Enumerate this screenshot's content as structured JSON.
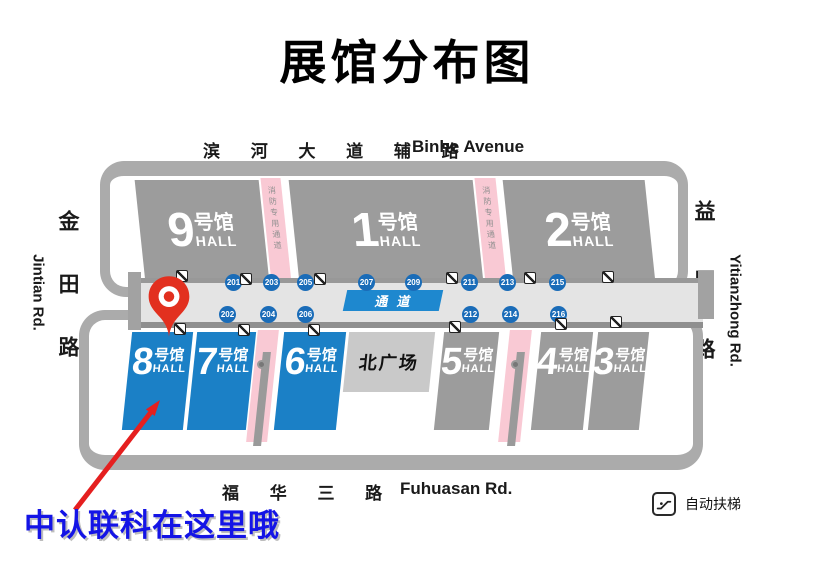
{
  "title": "展馆分布图",
  "roads": {
    "top_zh": "滨 河 大 道 辅 路",
    "top_en": "Binhe Avenue",
    "bottom_zh": "福 华 三 路",
    "bottom_en": "Fuhuasan Rd.",
    "left_zh": "金田路",
    "left_en": "Jintian Rd.",
    "right_zh": "益田路",
    "right_en": "Yitianzhong Rd."
  },
  "halls": {
    "top": [
      {
        "num": "9",
        "suffix": "号馆",
        "hall": "HALL"
      },
      {
        "num": "1",
        "suffix": "号馆",
        "hall": "HALL"
      },
      {
        "num": "2",
        "suffix": "号馆",
        "hall": "HALL"
      }
    ],
    "bottom": [
      {
        "num": "8",
        "suffix": "号馆",
        "hall": "HALL"
      },
      {
        "num": "7",
        "suffix": "号馆",
        "hall": "HALL"
      },
      {
        "num": "6",
        "suffix": "号馆",
        "hall": "HALL"
      },
      {
        "num": "5",
        "suffix": "号馆",
        "hall": "HALL"
      },
      {
        "num": "4",
        "suffix": "号馆",
        "hall": "HALL"
      },
      {
        "num": "3",
        "suffix": "号馆",
        "hall": "HALL"
      }
    ]
  },
  "plaza": {
    "label": "北广场"
  },
  "corridor": {
    "label": "通道",
    "gates_top": [
      "201",
      "203",
      "205",
      "207",
      "209",
      "211",
      "213",
      "215"
    ],
    "gates_bottom": [
      "202",
      "204",
      "206",
      "212",
      "214",
      "216"
    ]
  },
  "fire_lane_label": "消防专用通道",
  "legend": {
    "escalator_label": "自动扶梯"
  },
  "callout": {
    "text": "中认联科在这里哦"
  },
  "colors": {
    "hall_blue": "#1b80c6",
    "hall_gray": "#9c9c9c",
    "plaza_gray": "#c9c9c9",
    "corridor_gray": "#e4e4e4",
    "frame_gray": "#ababab",
    "fire_lane_pink": "#f9c9d4",
    "gate_blue": "#1a6cb8",
    "passage_blue": "#1e88cf",
    "pin_red": "#e2301f",
    "arrow_red": "#e51f1f",
    "callout_blue": "#1414e6"
  }
}
